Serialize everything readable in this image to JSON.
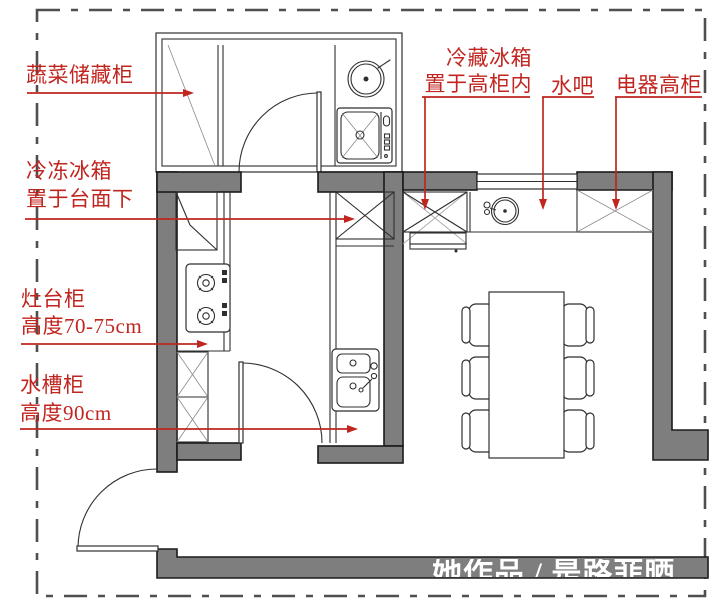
{
  "floor_plan": {
    "type": "kitchen-dining-floor-plan",
    "labels": {
      "veg_cabinet": "蔬菜储藏柜",
      "freezer_l1": "冷冻冰箱",
      "freezer_l2": "置于台面下",
      "stove_l1": "灶台柜",
      "stove_l2": "高度70-75cm",
      "sink_l1": "水槽柜",
      "sink_l2": "高度90cm",
      "fridge_l1": "冷藏冰箱",
      "fridge_l2": "置于高柜内",
      "water_bar": "水吧",
      "appliance_cabinet": "电器高柜"
    },
    "watermark": "她作品 / 是路菲晒",
    "colors": {
      "annotation_red": "#c1251f",
      "wall_gray": "#7e7e7e",
      "line_dark": "#2f2f2f",
      "watermark_white": "#ffffff"
    }
  }
}
